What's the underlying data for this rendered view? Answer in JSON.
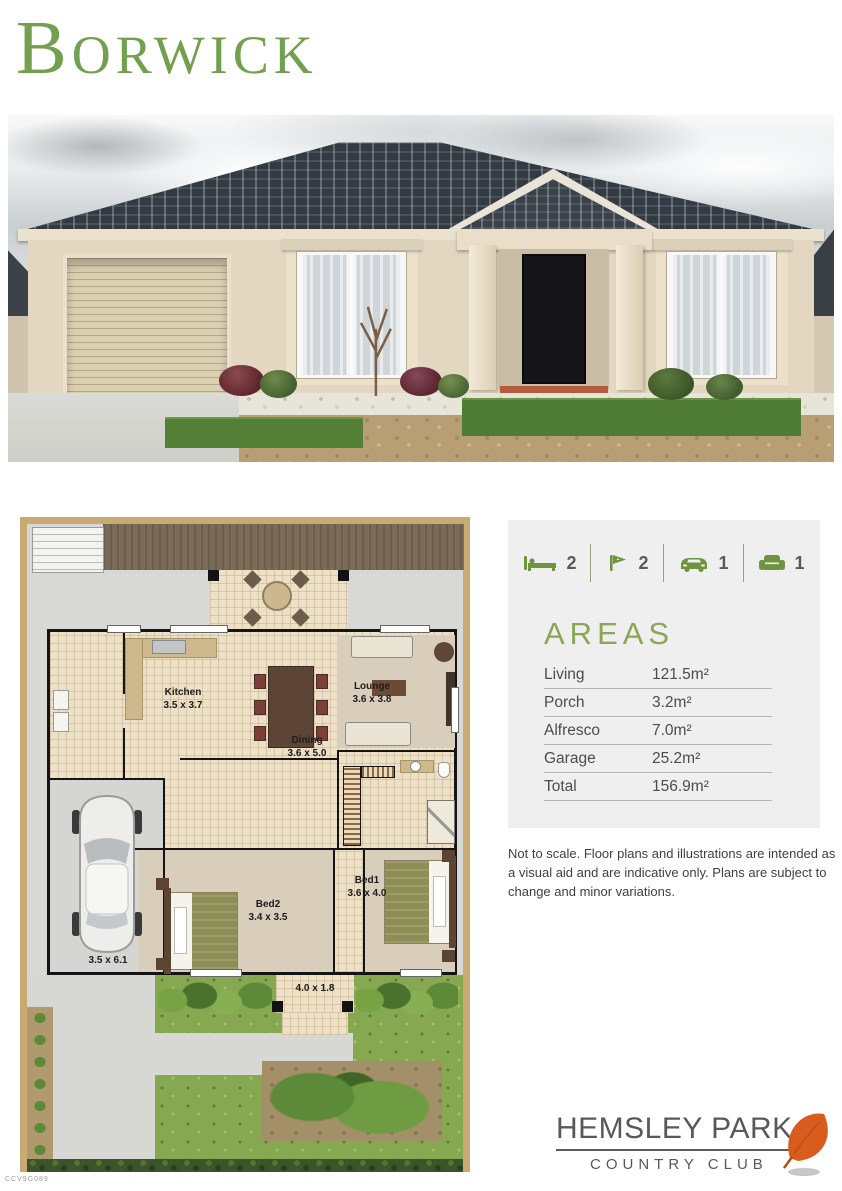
{
  "title": "BORWICK",
  "stats": {
    "items": [
      {
        "icon": "bed-icon",
        "value": "2"
      },
      {
        "icon": "shower-icon",
        "value": "2"
      },
      {
        "icon": "car-icon",
        "value": "1"
      },
      {
        "icon": "armchair-icon",
        "value": "1"
      }
    ]
  },
  "areas": {
    "heading": "AREAS",
    "rows": [
      {
        "label": "Living",
        "value": "121.5m²"
      },
      {
        "label": "Porch",
        "value": "3.2m²"
      },
      {
        "label": "Alfresco",
        "value": "7.0m²"
      },
      {
        "label": "Garage",
        "value": "25.2m²"
      },
      {
        "label": "Total",
        "value": "156.9m²"
      }
    ]
  },
  "disclaimer": "Not to scale. Floor plans and illustrations are intended as a visual aid and are indicative only. Plans are subject to change and minor variations.",
  "plan": {
    "rooms": {
      "kitchen": {
        "name": "Kitchen",
        "dims": "3.5 x 3.7"
      },
      "lounge": {
        "name": "Lounge",
        "dims": "3.6 x 3.8"
      },
      "dining": {
        "name": "Dining",
        "dims": "3.6 x 5.0"
      },
      "bed2": {
        "name": "Bed2",
        "dims": "3.4 x 3.5"
      },
      "bed1": {
        "name": "Bed1",
        "dims": "3.6 x 4.0"
      },
      "garage": {
        "dims": "3.5 x 6.1"
      },
      "porch": {
        "dims": "4.0 x 1.8"
      }
    }
  },
  "logo": {
    "name": "HEMSLEY PARK",
    "subtitle": "COUNTRY CLUB"
  },
  "footer_code": "CCV9G089",
  "colors": {
    "title_green": "#73a04f",
    "areas_green": "#8ca557",
    "icon_green": "#6f9440",
    "leaf_orange": "#d85c1d"
  }
}
